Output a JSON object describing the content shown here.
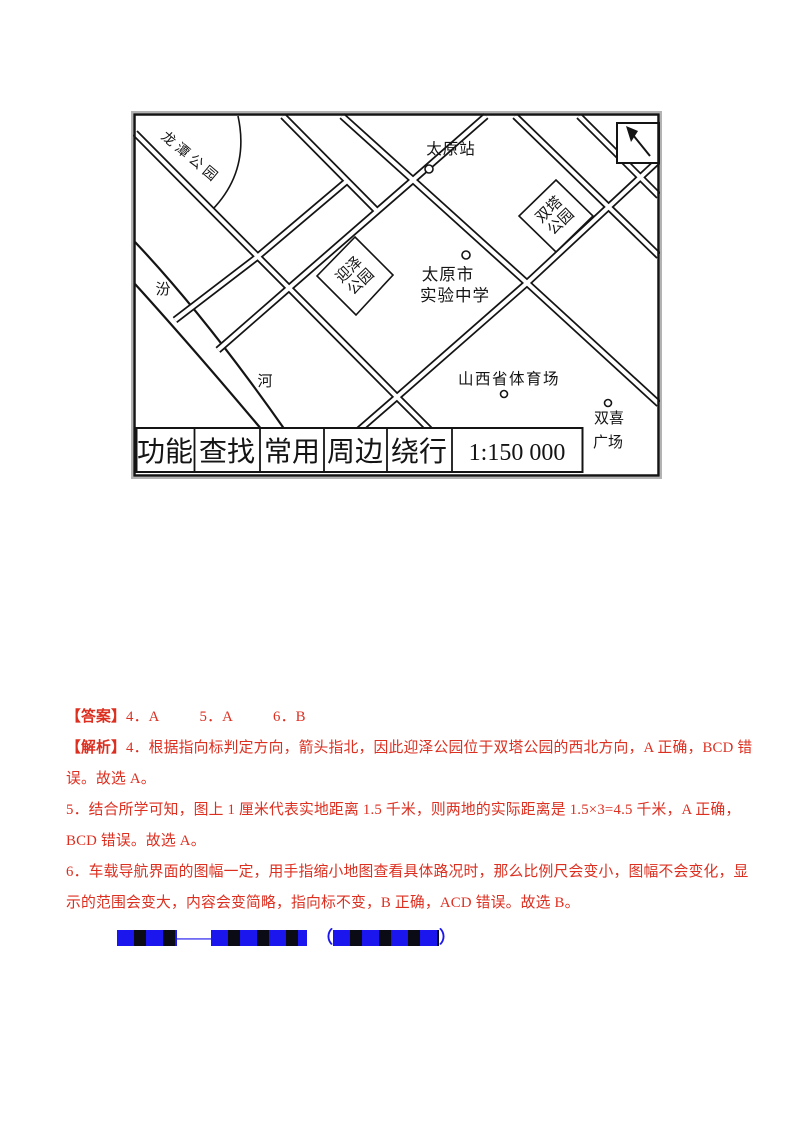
{
  "map": {
    "north_arrow": "northwest",
    "labels": {
      "longtan": "龙潭公园",
      "fen": "汾",
      "he": "河",
      "yingze1": "迎泽",
      "yingze2": "公园",
      "shuangta1": "双塔",
      "shuangta2": "公园",
      "station": "太原站",
      "school1": "太原市",
      "school2": "实验中学",
      "stadium": "山西省体育场",
      "shuangxi1": "双喜",
      "shuangxi2": "广场"
    },
    "toolbar": {
      "buttons": [
        "功能",
        "查找",
        "常用",
        "周边",
        "绕行"
      ],
      "scale": "1:150 000"
    }
  },
  "answers": {
    "header": "【答案】",
    "items": [
      "4．A",
      "5．A",
      "6．B"
    ]
  },
  "analysis": {
    "header": "【解析】",
    "line1": "4．根据指向标判定方向，箭头指北，因此迎泽公园位于双塔公园的西北方向，A 正确，BCD 错",
    "line2": "误。故选 A。",
    "line3": "5．结合所学可知，图上 1 厘米代表实地距离 1.5 千米，则两地的实际距离是 1.5×3=4.5 千米，A 正确，",
    "line4": "BCD 错误。故选 A。",
    "line5": "6．车载导航界面的图幅一定，用手指缩小地图查看具体路况时，那么比例尺会变小，图幅不会变化，显",
    "line6": "示的范围会变大，内容会变简略，指向标不变，B 正确，ACD 错误。故选 B。"
  },
  "watermark": {
    "dash": "——",
    "open": "（",
    "close": "）"
  },
  "colors": {
    "accent_red": "#dc2f20",
    "watermark_blue": "#1b16ee",
    "ink": "#141414",
    "scan_border_gray": "#b3b3b3"
  }
}
